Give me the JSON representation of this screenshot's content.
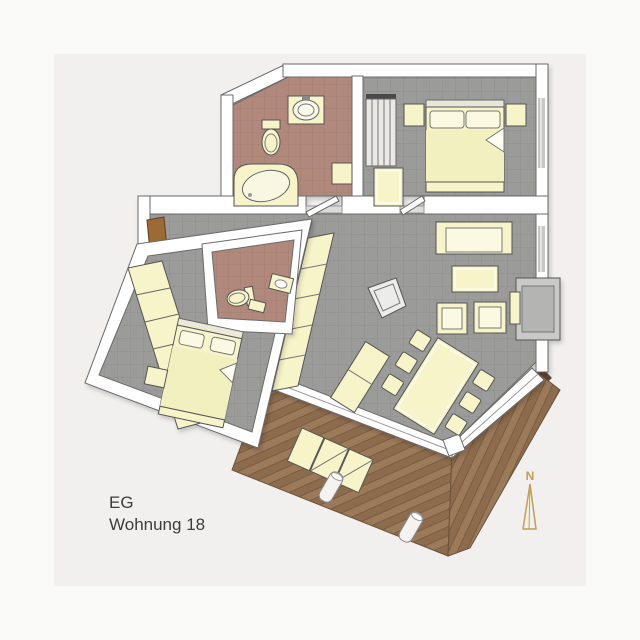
{
  "caption": {
    "floor_label": "EG",
    "apartment_label": "Wohnung 18"
  },
  "compass": {
    "north_label": "N"
  },
  "colors": {
    "page-bg": "#fafaf9",
    "matte": "#f1f0ee",
    "wall": "#ffffff",
    "outline": "#6a6a6a",
    "floor-gray": "#9b9b99",
    "grout-gray": "#8d8d8b",
    "floor-terra": "#b1897b",
    "grout-terra": "#a57e70",
    "wood": "#9b7a5a",
    "wood-alt": "#8d6c4d",
    "wood-dark": "#7a5b41",
    "wood-edge": "#5f4531",
    "furniture": "#f7f4c9",
    "furniture-light": "#fbf9e2",
    "blanket": "#f3f0bf",
    "door": "#9c6b35",
    "glass": "#c7c7c5",
    "stone": "#c9c9c7",
    "stone-dark": "#b4b4b2",
    "stair": "#e9e8e4",
    "dark": "#4a4a4a",
    "gold": "#c0a052",
    "text": "#3c3c3c"
  }
}
